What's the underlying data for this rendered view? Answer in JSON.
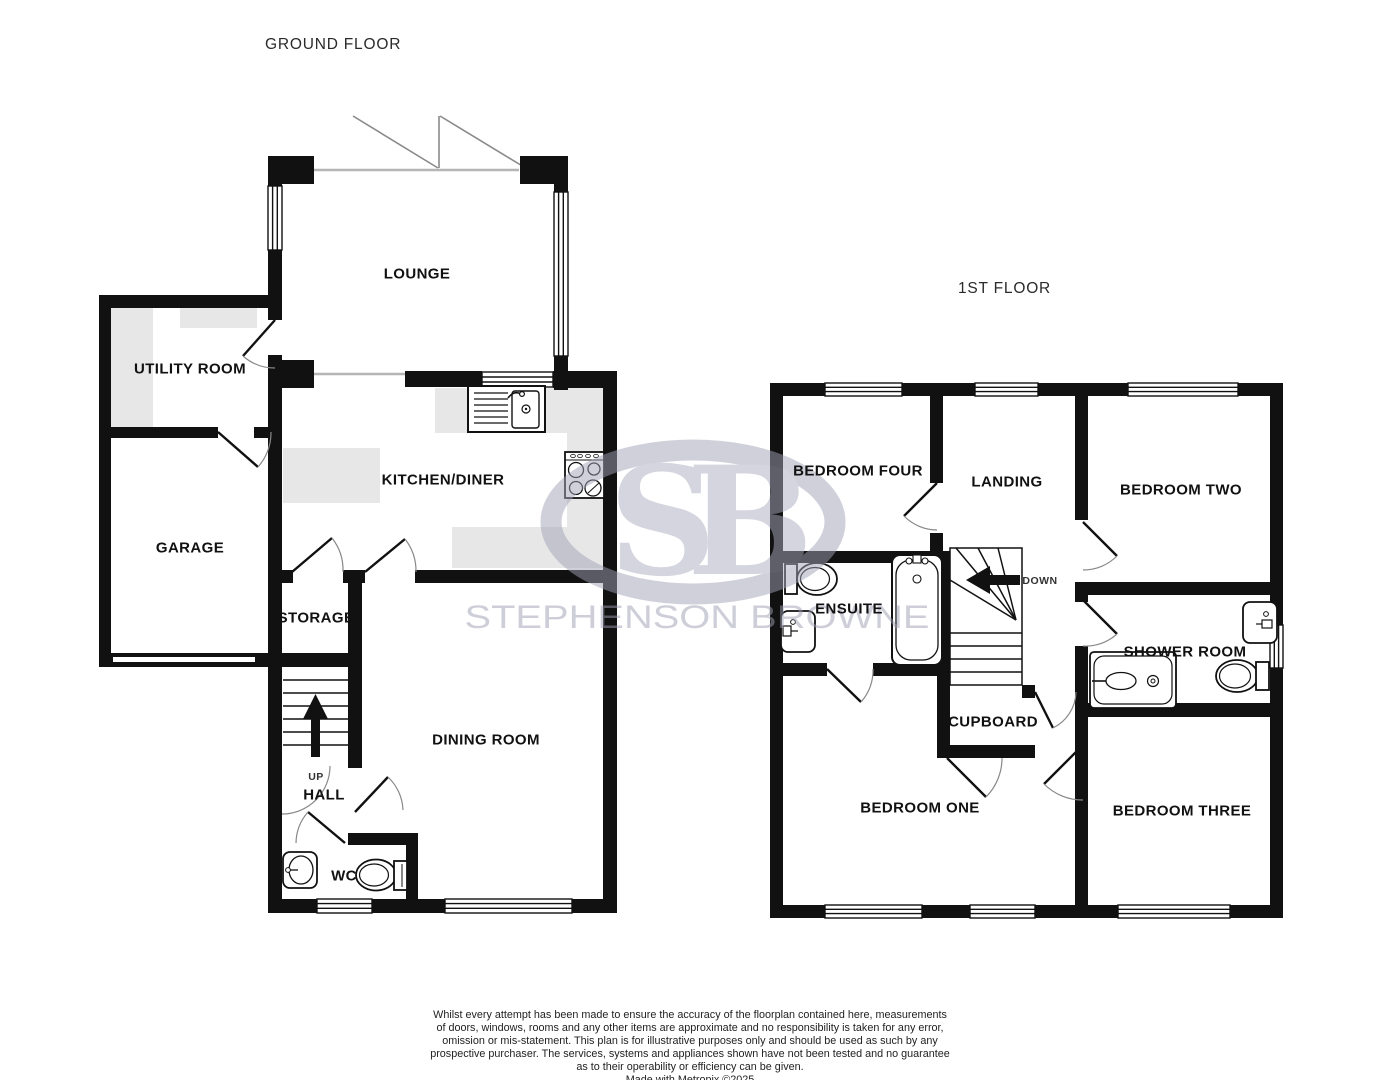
{
  "ground_floor": {
    "title": "GROUND FLOOR",
    "rooms": {
      "lounge": "LOUNGE",
      "utility": "UTILITY ROOM",
      "garage": "GARAGE",
      "kitchen": "KITCHEN/DINER",
      "storage": "STORAGE",
      "dining": "DINING ROOM",
      "hall": "HALL",
      "wc": "WC"
    },
    "stairs_direction": "UP"
  },
  "first_floor": {
    "title": "1ST FLOOR",
    "rooms": {
      "bedroom_four": "BEDROOM FOUR",
      "landing": "LANDING",
      "bedroom_two": "BEDROOM TWO",
      "ensuite": "ENSUITE",
      "cupboard": "CUPBOARD",
      "shower_room": "SHOWER ROOM",
      "bedroom_one": "BEDROOM ONE",
      "bedroom_three": "BEDROOM THREE"
    },
    "stairs_direction": "DOWN"
  },
  "watermark": {
    "monogram": "SB",
    "company": "STEPHENSON BROWNE"
  },
  "disclaimer": {
    "lines": [
      "Whilst every attempt has been made to ensure the accuracy of the floorplan contained here, measurements",
      "of doors, windows, rooms and any other items are approximate and no responsibility is taken for any error,",
      "omission or mis-statement. This plan is for illustrative purposes only and should be used as such by any",
      "prospective purchaser. The services, systems and appliances shown have not been tested and no guarantee",
      "as to their operability or efficiency can be given.",
      "Made with Metropix ©2025"
    ]
  },
  "colors": {
    "wall": "#111111",
    "counter": "#e7e7e7",
    "watermark": "#a2a2b8",
    "door_arc": "#888888"
  }
}
